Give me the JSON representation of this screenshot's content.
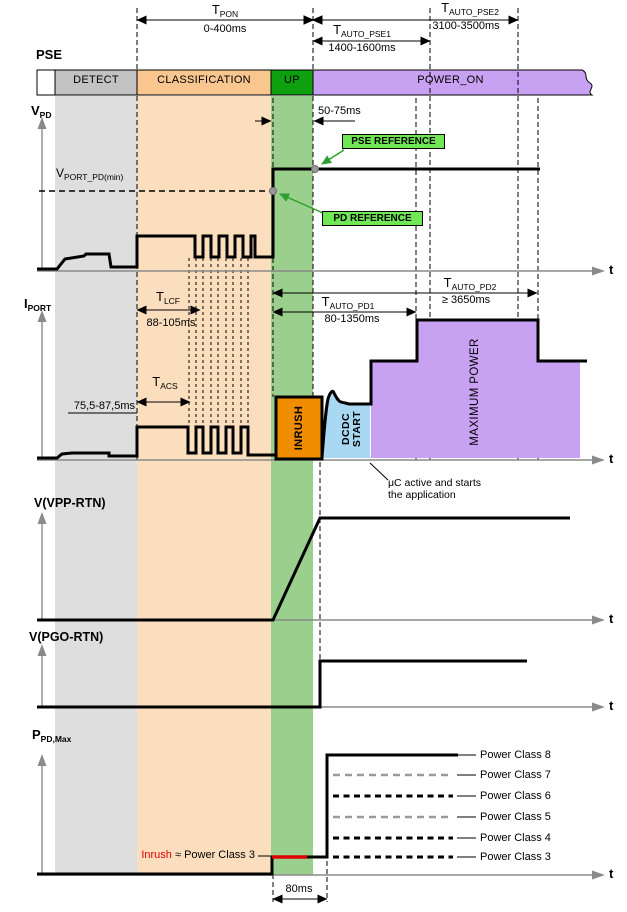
{
  "pse_title": "PSE",
  "t_axis_label": "t",
  "pse_bar": {
    "segments": [
      {
        "label": "DETECT"
      },
      {
        "label": "CLASSIFICATION"
      },
      {
        "label": "UP"
      },
      {
        "label": "POWER_ON"
      }
    ]
  },
  "timing": {
    "t_pon": {
      "main": "T",
      "sub": "PON",
      "range": "0-400ms"
    },
    "t_auto_pse1": {
      "main": "T",
      "sub": "AUTO_PSE1",
      "range": "1400-1600ms"
    },
    "t_auto_pse2": {
      "main": "T",
      "sub": "AUTO_PSE2",
      "range": "3100-3500ms"
    },
    "t_lcf": {
      "main": "T",
      "sub": "LCF",
      "range": "88-105ms"
    },
    "t_acs": {
      "main": "T",
      "sub": "ACS",
      "range": "75,5-87,5ms"
    },
    "t_auto_pd1": {
      "main": "T",
      "sub": "AUTO_PD1",
      "range": "80-1350ms"
    },
    "t_auto_pd2": {
      "main": "T",
      "sub": "AUTO_PD2",
      "range": "≥ 3650ms"
    },
    "up_window": "50-75ms",
    "inrush_window": "80ms"
  },
  "sections": {
    "vpd": {
      "axis_main": "V",
      "axis_sub": "PD",
      "vport_main": "V",
      "vport_sub": "PORT_PD(min)",
      "pse_reference": "PSE REFERENCE",
      "pd_reference": "PD REFERENCE"
    },
    "iport": {
      "axis_main": "I",
      "axis_sub": "PORT",
      "inrush": "INRUSH",
      "dcdc_line1": "DCDC",
      "dcdc_line2": "START",
      "max_power": "MAXIMUM POWER",
      "uc_note_line1": "μC active and starts",
      "uc_note_line2": "the application"
    },
    "vvpp": {
      "axis_label": "V(VPP-RTN)"
    },
    "vpgo": {
      "axis_label": "V(PGO-RTN)"
    },
    "ppd": {
      "axis_main": "P",
      "axis_sub": "PD,Max",
      "inrush_note_red": "Inrush",
      "inrush_note_black": " ≈ Power Class 3"
    }
  },
  "power_classes": [
    {
      "label": "Power Class 8"
    },
    {
      "label": "Power Class 7"
    },
    {
      "label": "Power Class 6"
    },
    {
      "label": "Power Class 5"
    },
    {
      "label": "Power Class 4"
    },
    {
      "label": "Power Class 3"
    }
  ],
  "colors": {
    "detect_bar": "#c2c2c2",
    "detect_band": "#dedede",
    "class_bar": "#f9c68f",
    "class_band": "#fbdebd",
    "up_bar": "#0fa00f",
    "up_band": "#9bcf8d",
    "power_on_bar": "#c9a1f2",
    "inrush_fill": "#f08c00",
    "dcdc_fill": "#a8d8f2",
    "max_power_fill": "#c9a1f2",
    "ref_box": "#70e755",
    "ref_arrow": "#2ca02c",
    "inrush_red": "#dd0000",
    "axis_gray": "#8a8a8a",
    "dot_gray": "#999999"
  }
}
